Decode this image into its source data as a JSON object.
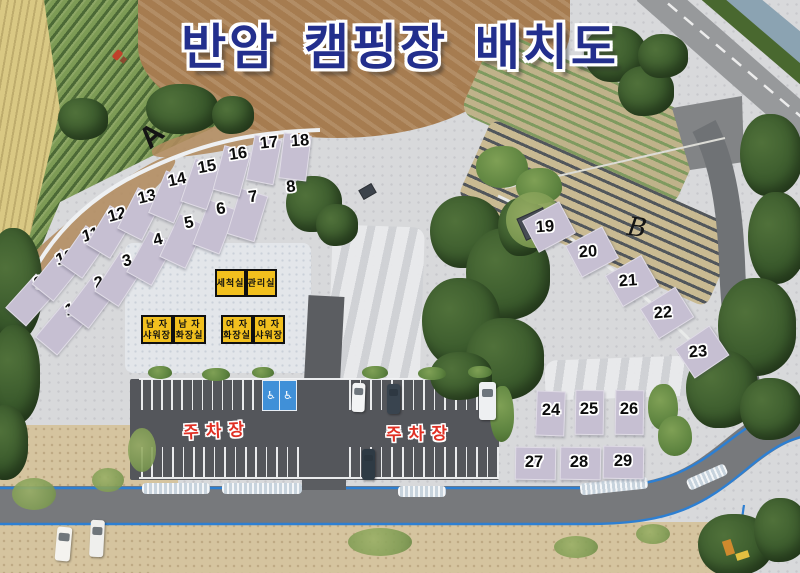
{
  "title": {
    "text": "반암 캠핑장 배치도"
  },
  "colors": {
    "title_navy": "#232f8d",
    "site_pad": "#c6bfd2",
    "facility_yellow": "#f2c01e",
    "parking_text_red": "#e03024",
    "boundary_blue_line": "#2d7fd2"
  },
  "sites": [
    {
      "n": "1",
      "x": 70,
      "y": 310,
      "rot": -16,
      "pad": {
        "x": 60,
        "y": 327,
        "w": 27,
        "h": 46,
        "rot": 40
      }
    },
    {
      "n": "2",
      "x": 99,
      "y": 283,
      "rot": -15,
      "pad": {
        "x": 90,
        "y": 300,
        "w": 27,
        "h": 46,
        "rot": 37
      }
    },
    {
      "n": "3",
      "x": 127,
      "y": 261,
      "rot": -14,
      "pad": {
        "x": 118,
        "y": 278,
        "w": 27,
        "h": 46,
        "rot": 33
      }
    },
    {
      "n": "4",
      "x": 158,
      "y": 240,
      "rot": -13,
      "pad": {
        "x": 149,
        "y": 257,
        "w": 27,
        "h": 46,
        "rot": 29
      }
    },
    {
      "n": "5",
      "x": 189,
      "y": 223,
      "rot": -12,
      "pad": {
        "x": 181,
        "y": 240,
        "w": 27,
        "h": 46,
        "rot": 25
      }
    },
    {
      "n": "6",
      "x": 221,
      "y": 209,
      "rot": -10,
      "pad": {
        "x": 213,
        "y": 226,
        "w": 27,
        "h": 46,
        "rot": 21
      }
    },
    {
      "n": "7",
      "x": 253,
      "y": 197,
      "rot": -8,
      "pad": {
        "x": 246,
        "y": 214,
        "w": 27,
        "h": 46,
        "rot": 17
      }
    },
    {
      "n": "8",
      "x": 291,
      "y": 187,
      "rot": -6,
      "pad": null
    },
    {
      "n": "9",
      "x": 39,
      "y": 283,
      "rot": -18,
      "pad": {
        "x": 30,
        "y": 299,
        "w": 26,
        "h": 44,
        "rot": 42
      }
    },
    {
      "n": "10",
      "x": 65,
      "y": 258,
      "rot": -17,
      "pad": {
        "x": 56,
        "y": 274,
        "w": 26,
        "h": 44,
        "rot": 39
      }
    },
    {
      "n": "11",
      "x": 91,
      "y": 235,
      "rot": -16,
      "pad": {
        "x": 83,
        "y": 251,
        "w": 26,
        "h": 44,
        "rot": 35
      }
    },
    {
      "n": "12",
      "x": 117,
      "y": 215,
      "rot": -15,
      "pad": {
        "x": 109,
        "y": 231,
        "w": 26,
        "h": 44,
        "rot": 31
      }
    },
    {
      "n": "13",
      "x": 147,
      "y": 197,
      "rot": -13,
      "pad": {
        "x": 139,
        "y": 213,
        "w": 26,
        "h": 44,
        "rot": 27
      }
    },
    {
      "n": "14",
      "x": 177,
      "y": 180,
      "rot": -12,
      "pad": {
        "x": 169,
        "y": 196,
        "w": 26,
        "h": 44,
        "rot": 23
      }
    },
    {
      "n": "15",
      "x": 207,
      "y": 167,
      "rot": -10,
      "pad": {
        "x": 200,
        "y": 183,
        "w": 26,
        "h": 44,
        "rot": 19
      }
    },
    {
      "n": "16",
      "x": 238,
      "y": 154,
      "rot": -8,
      "pad": {
        "x": 231,
        "y": 170,
        "w": 26,
        "h": 44,
        "rot": 15
      }
    },
    {
      "n": "17",
      "x": 269,
      "y": 143,
      "rot": -6,
      "pad": {
        "x": 263,
        "y": 159,
        "w": 26,
        "h": 44,
        "rot": 11
      }
    },
    {
      "n": "18",
      "x": 300,
      "y": 141,
      "rot": -4,
      "pad": {
        "x": 294,
        "y": 156,
        "w": 26,
        "h": 44,
        "rot": 7
      }
    },
    {
      "n": "19",
      "x": 545,
      "y": 227,
      "rot": -4,
      "pad": {
        "x": 548,
        "y": 226,
        "w": 40,
        "h": 34,
        "rot": -28
      }
    },
    {
      "n": "20",
      "x": 588,
      "y": 252,
      "rot": -4,
      "pad": {
        "x": 591,
        "y": 251,
        "w": 40,
        "h": 34,
        "rot": -28
      }
    },
    {
      "n": "21",
      "x": 628,
      "y": 281,
      "rot": -4,
      "pad": {
        "x": 631,
        "y": 280,
        "w": 40,
        "h": 34,
        "rot": -30
      }
    },
    {
      "n": "22",
      "x": 663,
      "y": 313,
      "rot": -4,
      "pad": {
        "x": 666,
        "y": 312,
        "w": 40,
        "h": 34,
        "rot": -32
      }
    },
    {
      "n": "23",
      "x": 698,
      "y": 352,
      "rot": -4,
      "pad": {
        "x": 701,
        "y": 351,
        "w": 40,
        "h": 34,
        "rot": -34
      }
    },
    {
      "n": "24",
      "x": 551,
      "y": 410,
      "rot": 0,
      "pad": {
        "x": 549,
        "y": 412,
        "w": 27,
        "h": 43,
        "rot": 2
      }
    },
    {
      "n": "25",
      "x": 589,
      "y": 409,
      "rot": 0,
      "pad": {
        "x": 588,
        "y": 411,
        "w": 27,
        "h": 43,
        "rot": 1
      }
    },
    {
      "n": "26",
      "x": 629,
      "y": 409,
      "rot": 0,
      "pad": {
        "x": 628,
        "y": 411,
        "w": 27,
        "h": 43,
        "rot": 1
      }
    },
    {
      "n": "27",
      "x": 534,
      "y": 462,
      "rot": 0,
      "pad": {
        "x": 534,
        "y": 462,
        "w": 39,
        "h": 31,
        "rot": 1
      }
    },
    {
      "n": "28",
      "x": 579,
      "y": 462,
      "rot": 0,
      "pad": {
        "x": 579,
        "y": 462,
        "w": 39,
        "h": 31,
        "rot": 1
      }
    },
    {
      "n": "29",
      "x": 623,
      "y": 461,
      "rot": 0,
      "pad": {
        "x": 622,
        "y": 461,
        "w": 39,
        "h": 31,
        "rot": 1
      }
    }
  ],
  "facilities": [
    {
      "id": "washing-room",
      "lines": [
        "세척실"
      ],
      "x": 215,
      "y": 269,
      "w": 31,
      "h": 28
    },
    {
      "id": "management-office",
      "lines": [
        "관리실"
      ],
      "x": 246,
      "y": 269,
      "w": 31,
      "h": 28
    },
    {
      "id": "mens-shower",
      "lines": [
        "남 자",
        "샤워장"
      ],
      "x": 141,
      "y": 315,
      "w": 32,
      "h": 29
    },
    {
      "id": "mens-toilet",
      "lines": [
        "남 자",
        "화장실"
      ],
      "x": 173,
      "y": 315,
      "w": 33,
      "h": 29
    },
    {
      "id": "womens-toilet",
      "lines": [
        "여 자",
        "화장실"
      ],
      "x": 221,
      "y": 315,
      "w": 32,
      "h": 29
    },
    {
      "id": "womens-shower",
      "lines": [
        "여 자",
        "샤워장"
      ],
      "x": 253,
      "y": 315,
      "w": 32,
      "h": 29
    }
  ],
  "parking": {
    "labels": [
      {
        "text": "주차장",
        "x": 217,
        "y": 429,
        "rot": -3
      },
      {
        "text": "주차장",
        "x": 420,
        "y": 432,
        "rot": -1
      }
    ],
    "accessible_symbol": "♿",
    "stall_rows": [
      {
        "x": 141,
        "y": 380,
        "len": 30,
        "count": 13,
        "gap": 10.1
      },
      {
        "x": 349,
        "y": 380,
        "len": 30,
        "count": 15,
        "gap": 10.6
      },
      {
        "x": 141,
        "y": 447,
        "len": 30,
        "count": 16,
        "gap": 10.4
      },
      {
        "x": 349,
        "y": 447,
        "len": 30,
        "count": 15,
        "gap": 10.6
      }
    ]
  },
  "markers": [
    {
      "label": "A",
      "x": 152,
      "y": 136,
      "rot": -42,
      "style": "bold"
    },
    {
      "label": "B",
      "x": 637,
      "y": 228,
      "rot": 8,
      "style": "italic"
    }
  ],
  "vehicles": [
    {
      "kind": "car",
      "color": "#f3f4f5",
      "x": 352,
      "y": 383,
      "w": 13,
      "h": 29,
      "rot": 2
    },
    {
      "kind": "car",
      "color": "#39444f",
      "x": 387,
      "y": 384,
      "w": 13,
      "h": 30,
      "rot": 0
    },
    {
      "kind": "truck",
      "color": "#eef0f2",
      "x": 479,
      "y": 382,
      "w": 17,
      "h": 38,
      "rot": 0
    },
    {
      "kind": "car",
      "color": "#2e3a44",
      "x": 362,
      "y": 449,
      "w": 13,
      "h": 31,
      "rot": 0
    },
    {
      "kind": "van",
      "color": "#f4f3ef",
      "x": 56,
      "y": 527,
      "w": 15,
      "h": 34,
      "rot": 5
    },
    {
      "kind": "van",
      "color": "#efefed",
      "x": 90,
      "y": 520,
      "w": 14,
      "h": 37,
      "rot": 3
    }
  ]
}
